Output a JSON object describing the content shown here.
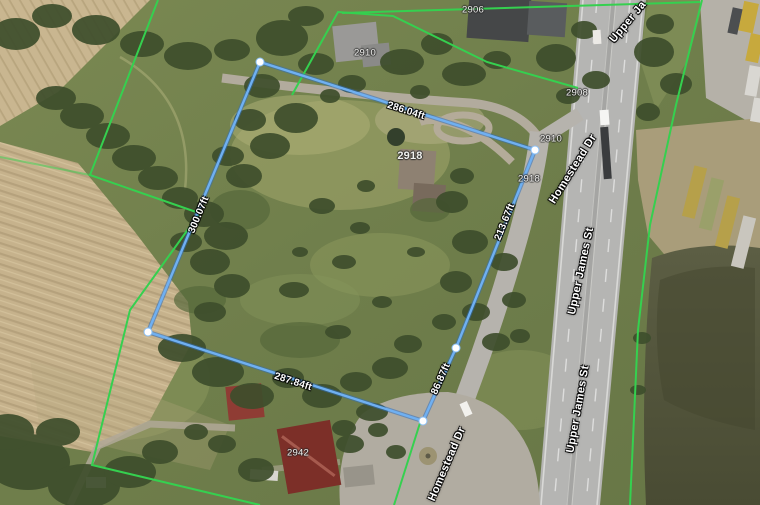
{
  "map": {
    "streets": {
      "upper_james_st": "Upper James St",
      "homestead_dr": "Homestead Dr",
      "upper_james_partial": "Upper Ja"
    },
    "house_numbers": [
      "2906",
      "2910",
      "2918",
      "2908",
      "2910",
      "2918",
      "2942"
    ],
    "measurements": {
      "top_edge": "286.04ft",
      "left_edge": "300.07ft",
      "bottom_edge": "287.84ft",
      "right_upper_edge": "213.67ft",
      "right_lower_edge": "86.87ft"
    },
    "colors": {
      "measurement_line": "#5b9ee8",
      "measurement_vertex": "#ffffff",
      "parcel_boundary_line": "#35d04f"
    }
  }
}
